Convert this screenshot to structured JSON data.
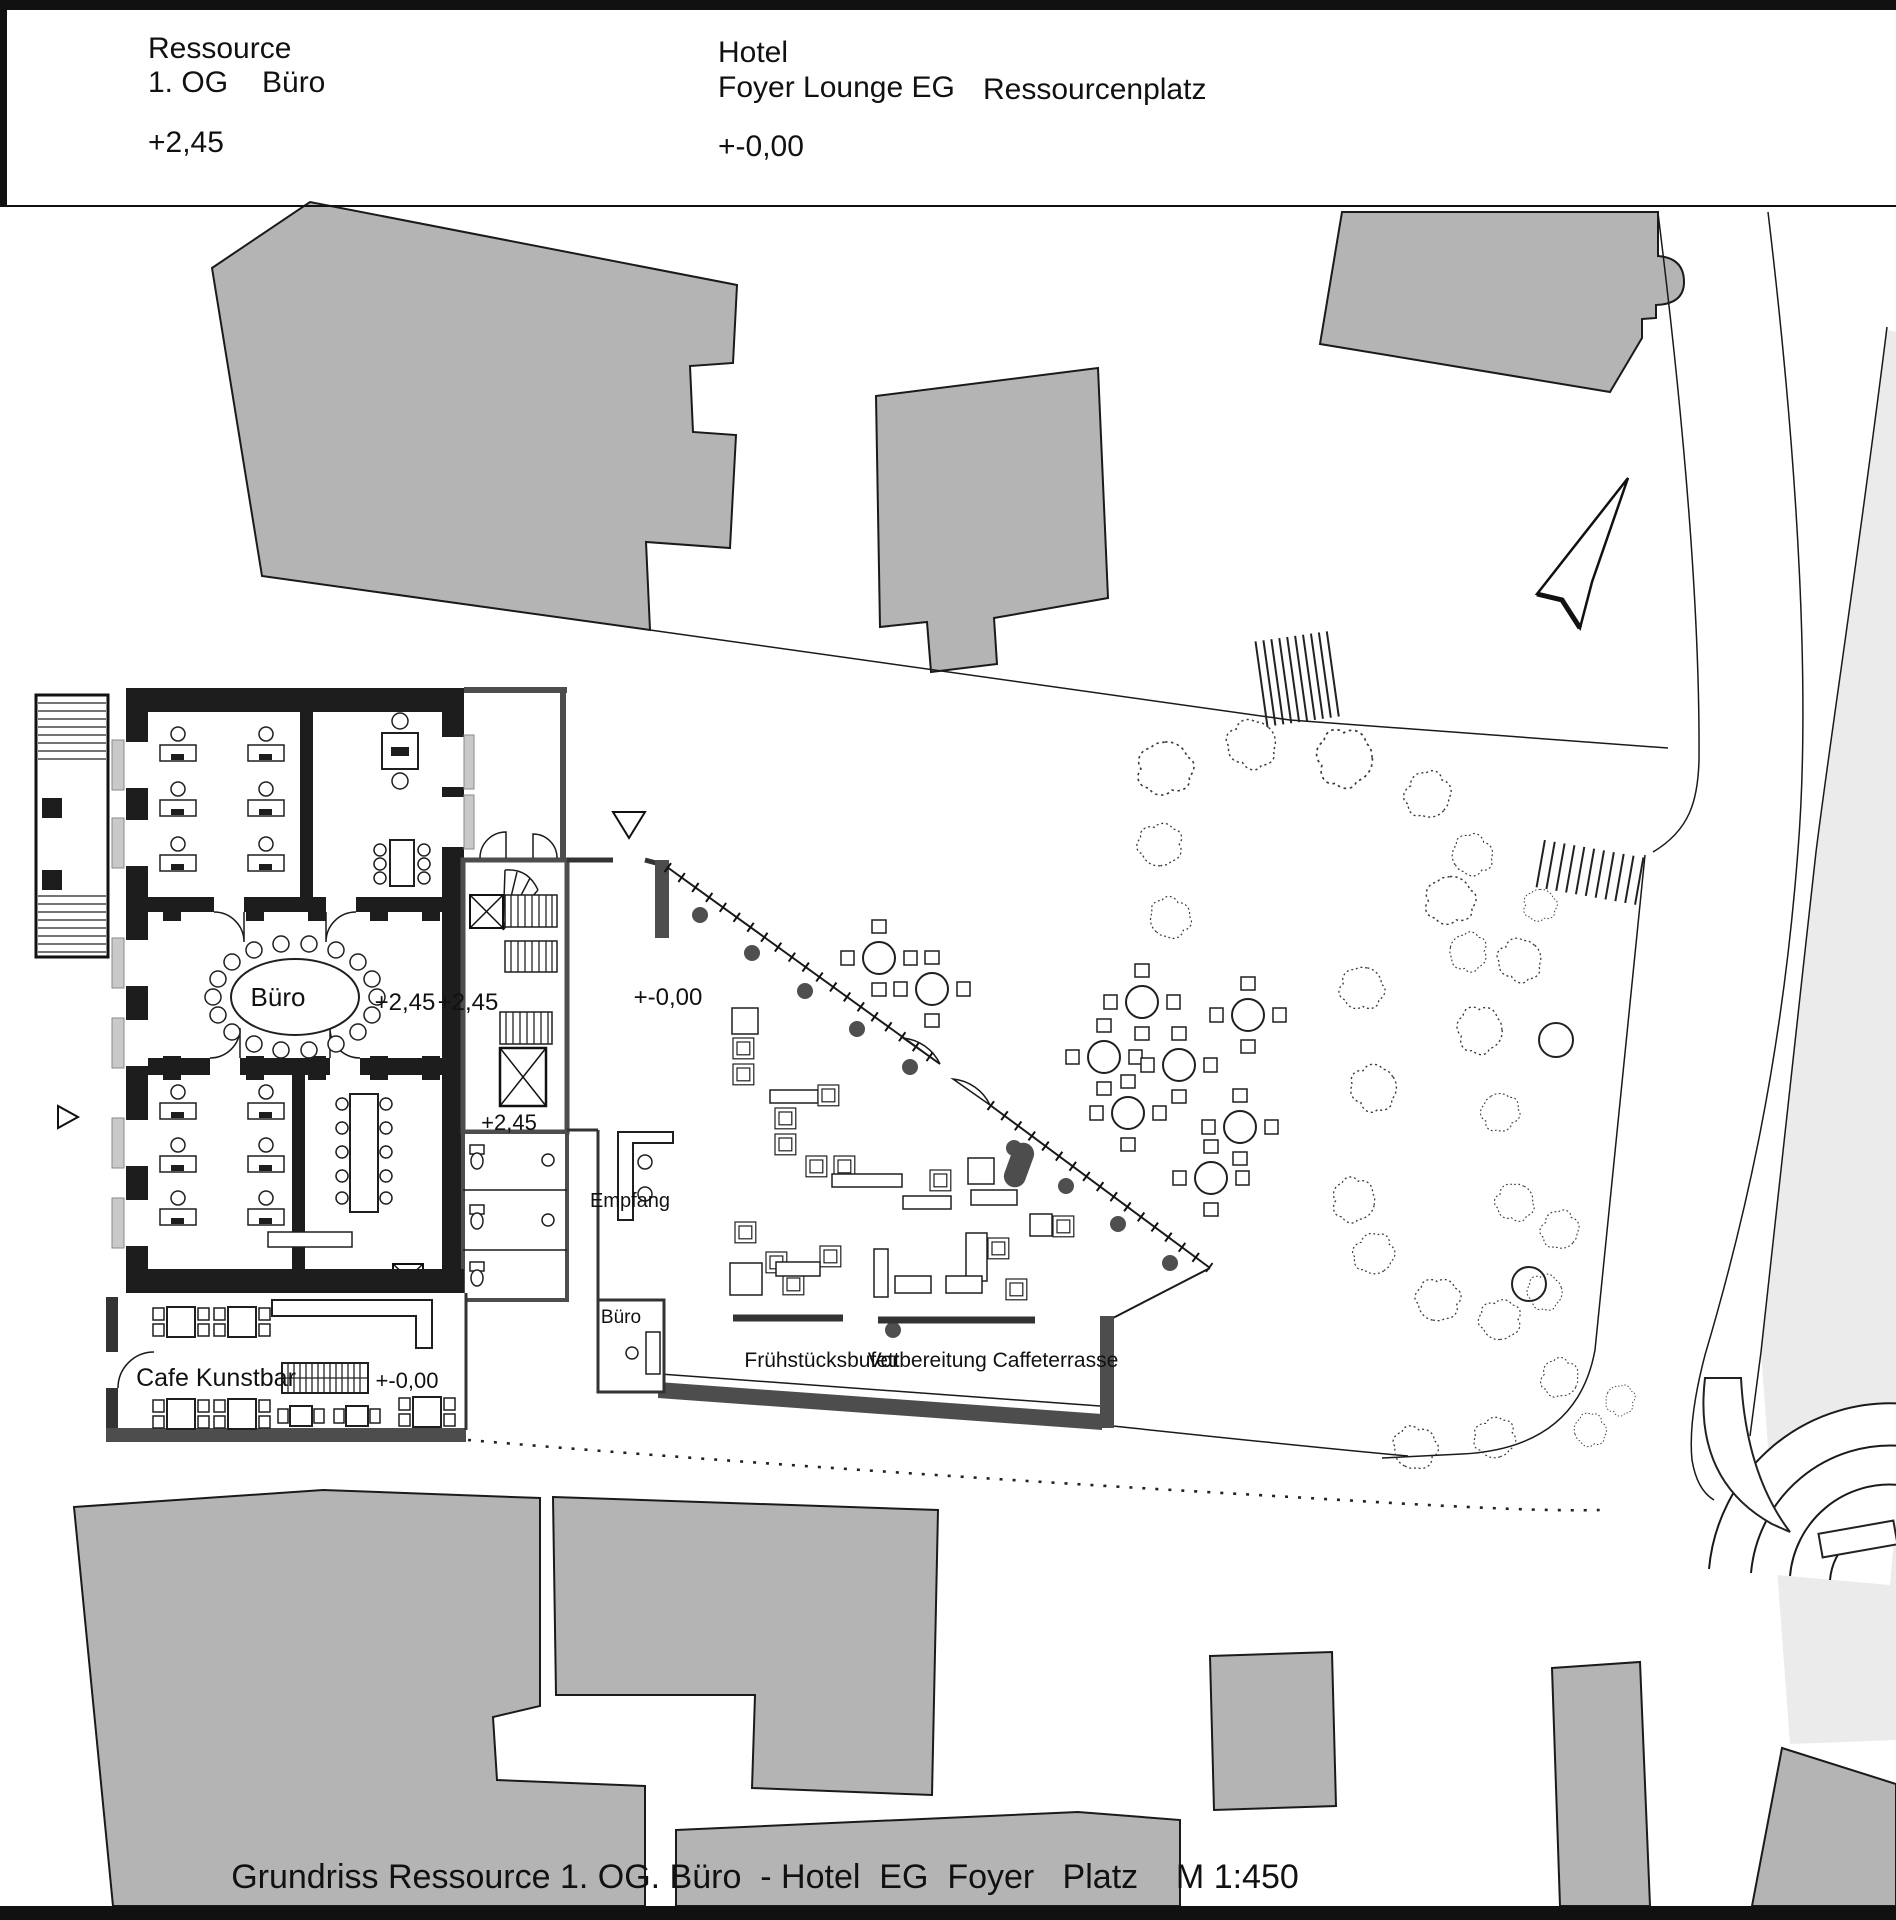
{
  "header": {
    "project": "Ressource",
    "floor": "1. OG",
    "use": "Büro",
    "level_left": "+2,45",
    "building": "Hotel",
    "area": "Foyer Lounge EG",
    "place": "Ressourcenplatz",
    "level_right": "+-0,00"
  },
  "plan": {
    "office_label": "Büro",
    "office_level_a": "+2,45",
    "office_level_b": "+2,45",
    "core_level": "+2,45",
    "foyer_level": "+-0,00",
    "reception_label": "Empfang",
    "office_small_label": "Büro",
    "buffet_label": "Frühstücksbufett",
    "terrace_prep_label": "Vorbereitung Caffeterrasse",
    "cafe_label": "Cafe Kunstbar",
    "cafe_level": "+-0,00"
  },
  "footer": {
    "title": "Grundriss Ressource 1. OG. Büro  - Hotel  EG  Foyer   Platz    M 1:450"
  },
  "colors": {
    "neighbor_building": "#b4b4b4",
    "wall_black": "#1d1d1d",
    "wall_dark": "#4d4d4d",
    "paper": "#ffffff",
    "light_area": "#ebebeb",
    "line": "#1a1a1a"
  }
}
